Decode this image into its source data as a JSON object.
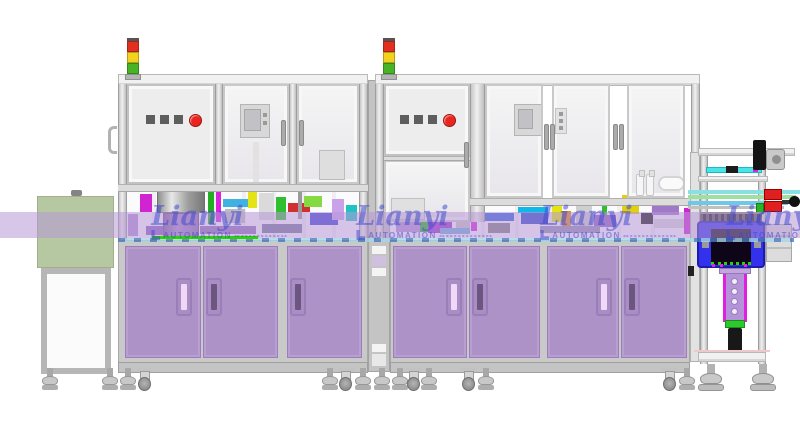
{
  "scene": {
    "type": "CAD elevation rendering",
    "description": "Two-bay enclosed automation assembly line with stack lights, e-stop control panels, purple lower cabinets, pass-through conveyor, left infeed stand and right outfeed test station"
  },
  "watermark": {
    "brand": "Lianyi",
    "subtitle": "AUTOMATION",
    "instances": [
      {
        "x": 219
      },
      {
        "x": 424
      },
      {
        "x": 608
      },
      {
        "x": 794
      }
    ]
  },
  "tower": {
    "segments": [
      {
        "name": "red",
        "color": "#e0301e"
      },
      {
        "name": "amber",
        "color": "#f2d21e"
      },
      {
        "name": "green",
        "color": "#46b424"
      }
    ],
    "instances": [
      {
        "x": 127
      },
      {
        "x": 383
      }
    ]
  },
  "control_panels": {
    "square_buttons": 3,
    "instances": [
      {
        "x": 146,
        "y": 114
      },
      {
        "x": 400,
        "y": 114
      }
    ]
  },
  "colors": {
    "door_purple": "#ad92c8",
    "door_border": "#9b7fb8",
    "handle_light": "#f0d8f6",
    "handle_dark": "#6b5680",
    "band": "rgba(182,152,214,0.55)",
    "conveyor_line": "#a8d4e4",
    "conveyor_dash": "#4a7ac0",
    "bright_green": "#2bd400",
    "watermark": "rgba(62,70,205,0.52)",
    "button_gray": "#5e5e5e",
    "estop": "#e8251f",
    "tower_red": "#e0301e",
    "tower_amber": "#f2d21e",
    "tower_green": "#46b424",
    "green_stand": "#b6c8a2",
    "blue_housing": "#3232ec",
    "cyan_plate": "#48e4e8",
    "magenta": "#e020e0"
  },
  "internals": {
    "machine1": [
      [
        128,
        214,
        10,
        22,
        "#b290d4"
      ],
      [
        140,
        194,
        12,
        18,
        "#cf24cf"
      ],
      [
        146,
        226,
        34,
        9,
        "#8a5fc0"
      ],
      [
        208,
        188,
        6,
        36,
        "#23ad23"
      ],
      [
        216,
        192,
        5,
        30,
        "#d922d9"
      ],
      [
        223,
        199,
        26,
        8,
        "#3fb2e2"
      ],
      [
        225,
        209,
        20,
        14,
        "#bcbcbc"
      ],
      [
        248,
        188,
        9,
        20,
        "#e4e414"
      ],
      [
        259,
        193,
        15,
        27,
        "#dadada"
      ],
      [
        276,
        197,
        10,
        23,
        "#2fbf2f"
      ],
      [
        288,
        203,
        22,
        9,
        "#d03030"
      ],
      [
        298,
        189,
        4,
        30,
        "#9a9a9a"
      ],
      [
        304,
        196,
        18,
        11,
        "#85d943"
      ],
      [
        310,
        213,
        28,
        12,
        "#3d3dd3"
      ],
      [
        332,
        199,
        12,
        21,
        "#c9a2ea"
      ],
      [
        346,
        205,
        11,
        16,
        "#1fc3c3"
      ],
      [
        152,
        186,
        42,
        4,
        "#dede10"
      ],
      [
        200,
        226,
        56,
        8,
        "#9070b8"
      ],
      [
        262,
        224,
        40,
        9,
        "#777799"
      ]
    ],
    "machine2": [
      [
        392,
        200,
        24,
        18,
        "#d2d2d2"
      ],
      [
        396,
        222,
        32,
        10,
        "#b190d2"
      ],
      [
        420,
        204,
        8,
        28,
        "#23ad23"
      ],
      [
        428,
        218,
        24,
        4,
        "#10d0d0"
      ],
      [
        428,
        222,
        24,
        11,
        "#9b30d0"
      ],
      [
        456,
        208,
        14,
        22,
        "#c6c6c6"
      ],
      [
        471,
        199,
        6,
        32,
        "#d922d9"
      ],
      [
        480,
        213,
        34,
        8,
        "#3060e0"
      ],
      [
        488,
        223,
        22,
        10,
        "#7e7e7e"
      ],
      [
        518,
        207,
        30,
        6,
        "#10b8e8"
      ],
      [
        521,
        213,
        27,
        11,
        "#2a46ca"
      ],
      [
        552,
        195,
        10,
        27,
        "#e4e414"
      ],
      [
        562,
        211,
        9,
        19,
        "#e08812"
      ],
      [
        576,
        205,
        16,
        25,
        "#cfcfcf"
      ],
      [
        594,
        215,
        22,
        12,
        "#8a5fc0"
      ],
      [
        602,
        195,
        5,
        20,
        "#2fbf2f"
      ],
      [
        622,
        195,
        17,
        19,
        "#e0d010"
      ],
      [
        641,
        213,
        12,
        11,
        "#161616"
      ],
      [
        652,
        197,
        27,
        18,
        "#a078c8"
      ],
      [
        654,
        219,
        32,
        9,
        "#d8d8d8"
      ],
      [
        684,
        208,
        6,
        26,
        "#cf24cf"
      ],
      [
        540,
        226,
        60,
        7,
        "#8f8fb0"
      ],
      [
        440,
        228,
        30,
        6,
        "#70b0d8"
      ]
    ]
  },
  "feet": {
    "baseline_y": 368,
    "items": [
      {
        "t": "lv",
        "x": 42
      },
      {
        "t": "lv",
        "x": 102
      },
      {
        "t": "lv",
        "x": 120
      },
      {
        "t": "ca",
        "x": 137
      },
      {
        "t": "lv",
        "x": 322
      },
      {
        "t": "ca",
        "x": 338
      },
      {
        "t": "lv",
        "x": 355
      },
      {
        "t": "lv",
        "x": 374
      },
      {
        "t": "lv",
        "x": 392
      },
      {
        "t": "ca",
        "x": 406
      },
      {
        "t": "lv",
        "x": 421
      },
      {
        "t": "ca",
        "x": 461
      },
      {
        "t": "lv",
        "x": 478
      },
      {
        "t": "ca",
        "x": 662
      },
      {
        "t": "lv",
        "x": 679
      },
      {
        "t": "big",
        "x": 698
      },
      {
        "t": "big",
        "x": 750
      }
    ]
  }
}
